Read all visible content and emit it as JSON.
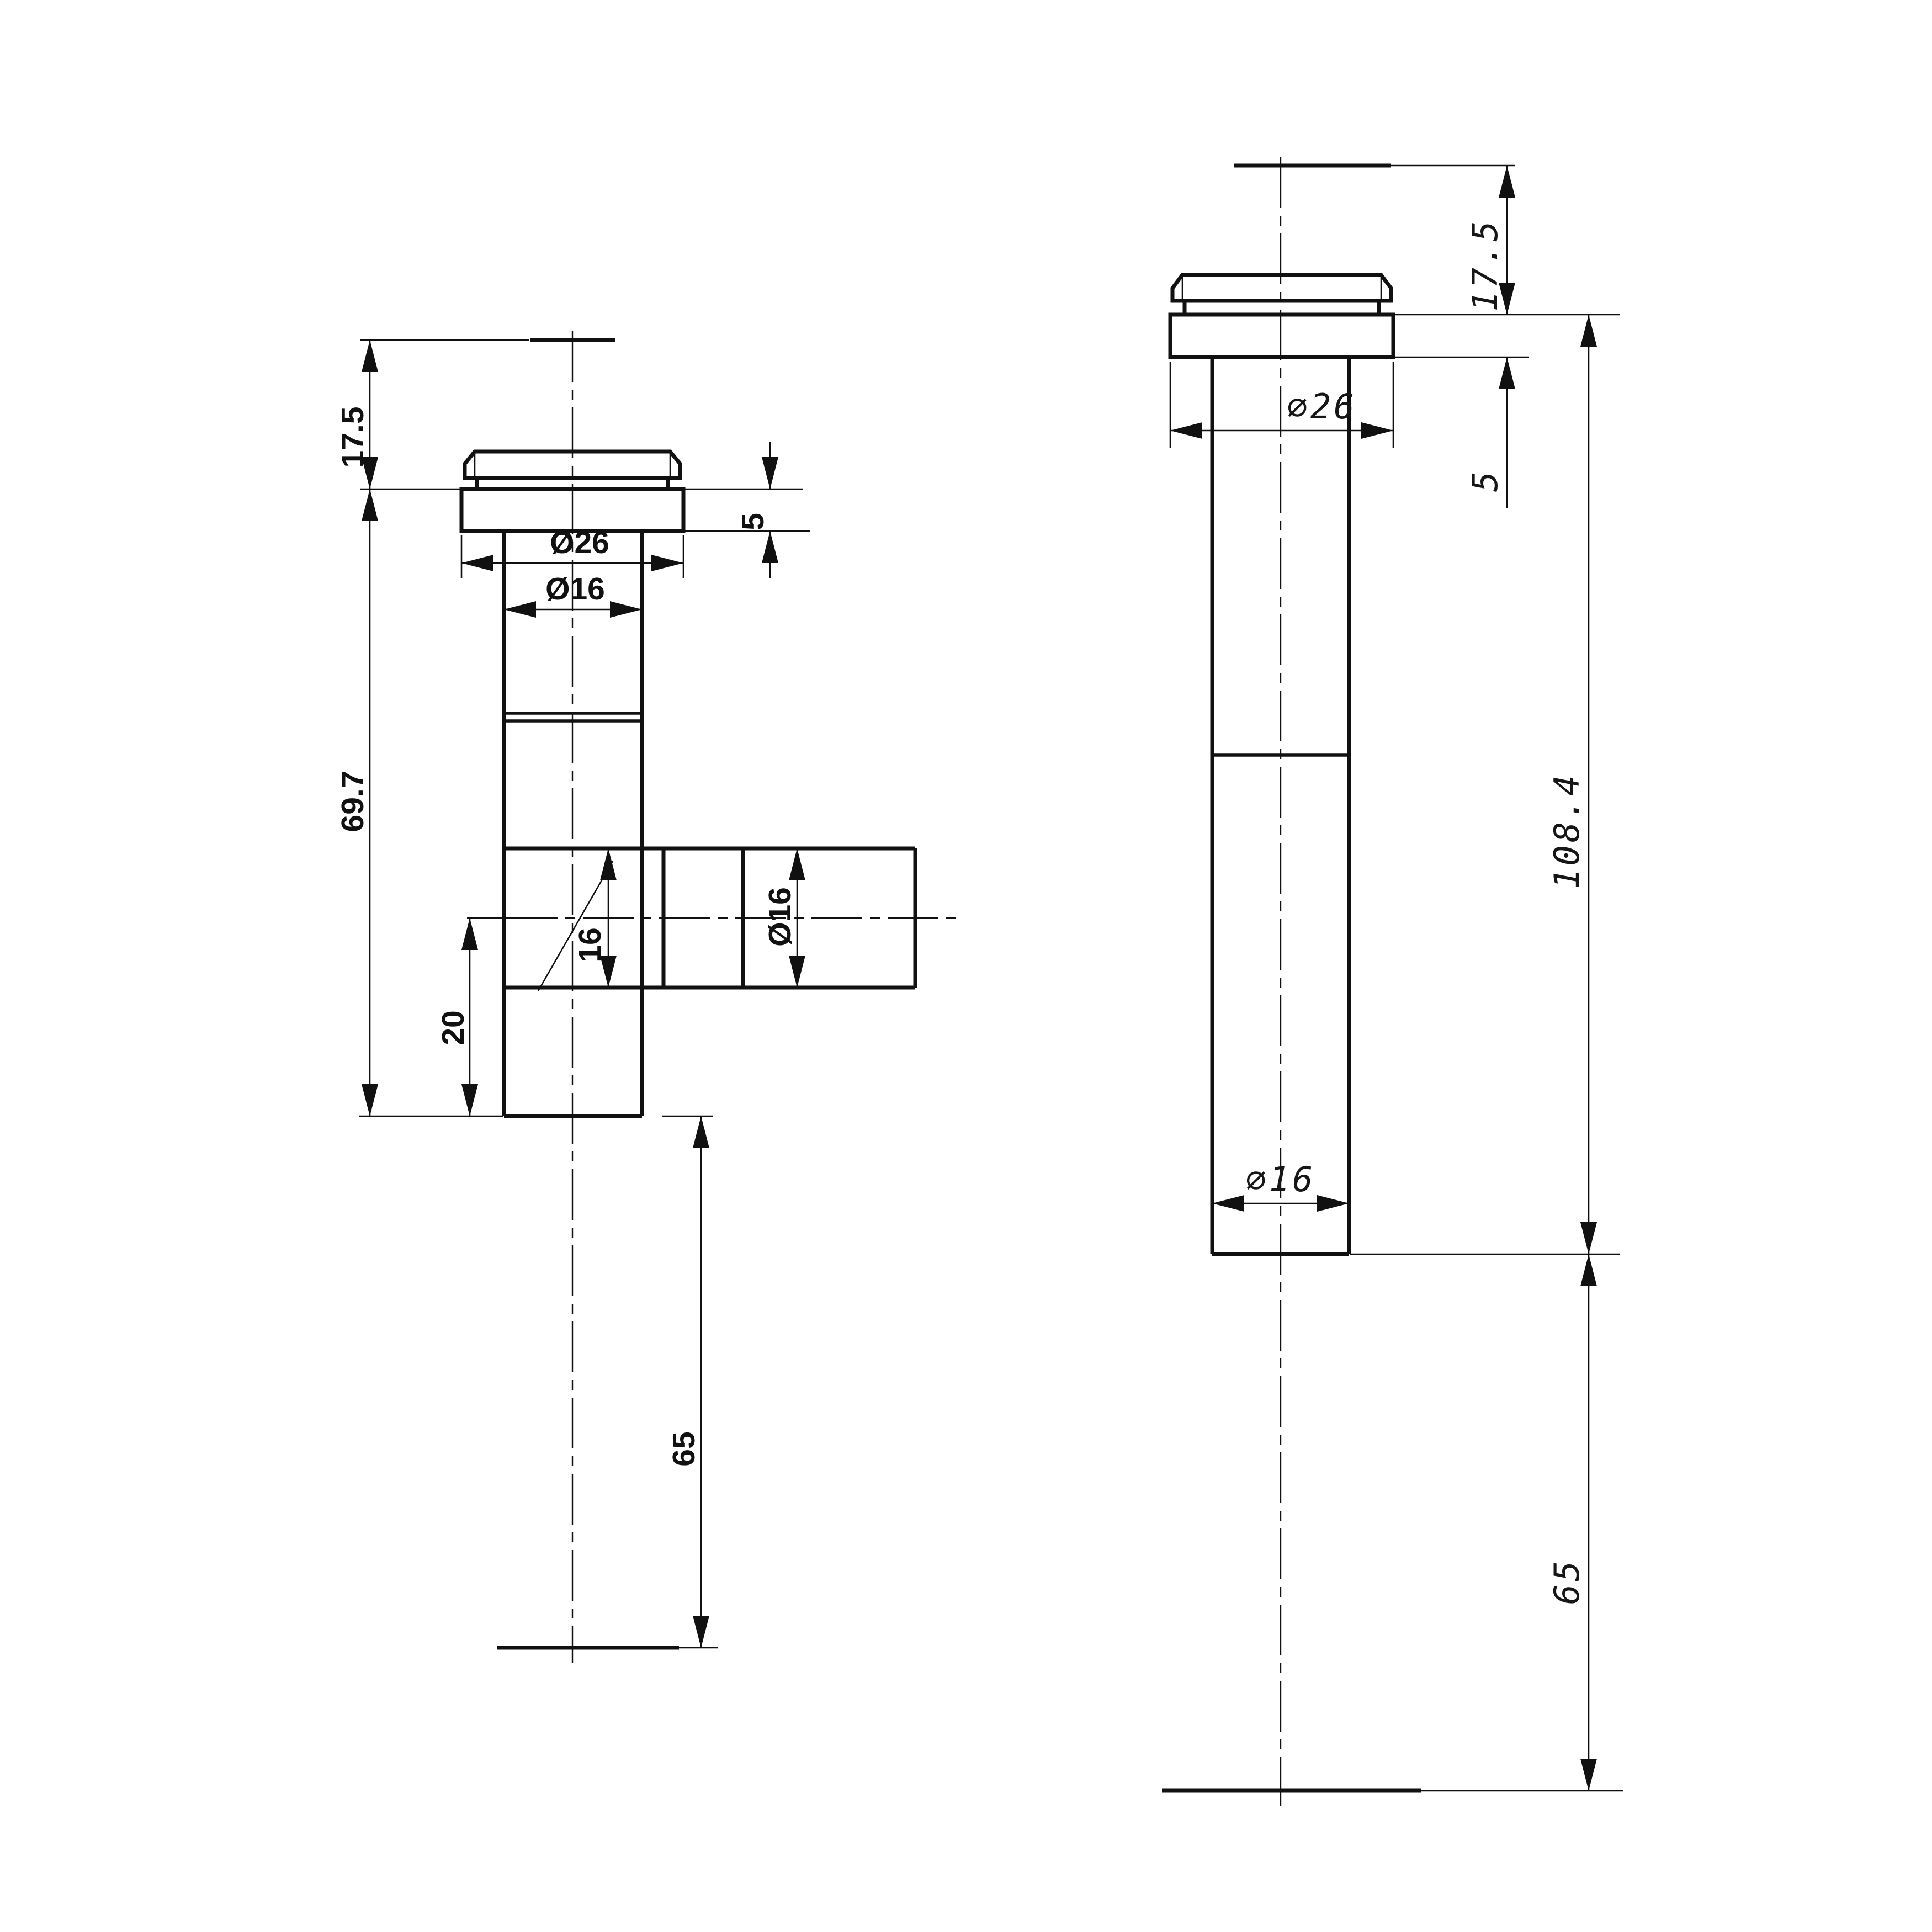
{
  "front_view": {
    "top_height": "17.5",
    "flange_thickness": "5",
    "flange_diameter": "Ø26",
    "tube_diameter": "Ø16",
    "body_length": "69.7",
    "branch_bore": "16",
    "branch_diameter": "Ø16",
    "tail_offset": "20",
    "tail_length": "65"
  },
  "side_view": {
    "top_height": "17.5",
    "flange_diameter": "∅26",
    "flange_thickness": "5",
    "total_length": "108.4",
    "tube_diameter": "∅16",
    "tail_length": "65"
  },
  "colors": {
    "line": "#111111",
    "background": "#ffffff"
  }
}
